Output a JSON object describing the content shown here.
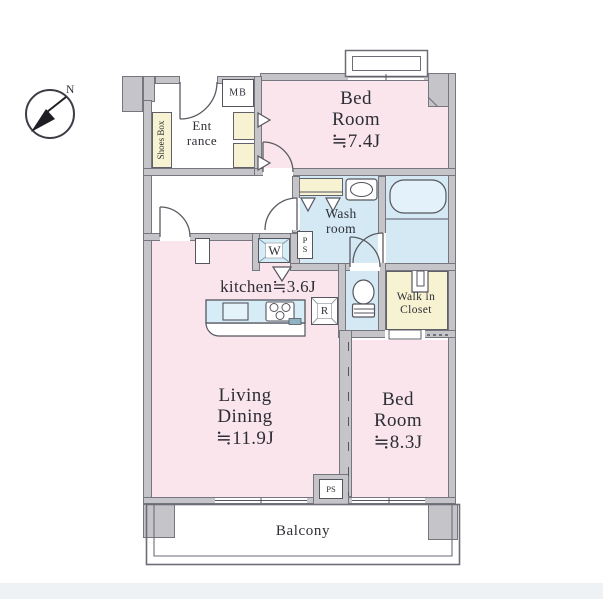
{
  "compass": {
    "north_label": "N"
  },
  "rooms": {
    "bedroom_top": {
      "line1": "Bed",
      "line2": "Room",
      "line3": "≒7.4J"
    },
    "living_dining": {
      "line1": "Living",
      "line2": "Dining",
      "line3": "≒11.9J"
    },
    "bedroom_right": {
      "line1": "Bed",
      "line2": "Room",
      "line3": "≒8.3J"
    },
    "kitchen": {
      "label": "kitchen≒3.6J"
    },
    "washroom": {
      "line1": "Wash",
      "line2": "room"
    },
    "walk_in_closet": {
      "line1": "Walk in",
      "line2": "Closet"
    },
    "entrance": {
      "line1": "Ent",
      "line2": "rance"
    },
    "balcony": {
      "label": "Balcony"
    }
  },
  "fixtures": {
    "shoes_box_label": "Shoes Box",
    "meter_box_label": "MB",
    "washing_machine_label": "W",
    "pipe_shaft_upper": {
      "line1": "P",
      "line2": "S"
    },
    "refrigerator_label": "R",
    "pipe_shaft_lower_label": "PS"
  },
  "colors": {
    "room_pink": "#f9e5eb",
    "wet_area_blue": "#d4e9f4",
    "storage_yellow": "#f7f2d1",
    "counter_blue": "#d6ecf7",
    "wall_gray": "#c5c5c9",
    "line_dark": "#55555e"
  }
}
